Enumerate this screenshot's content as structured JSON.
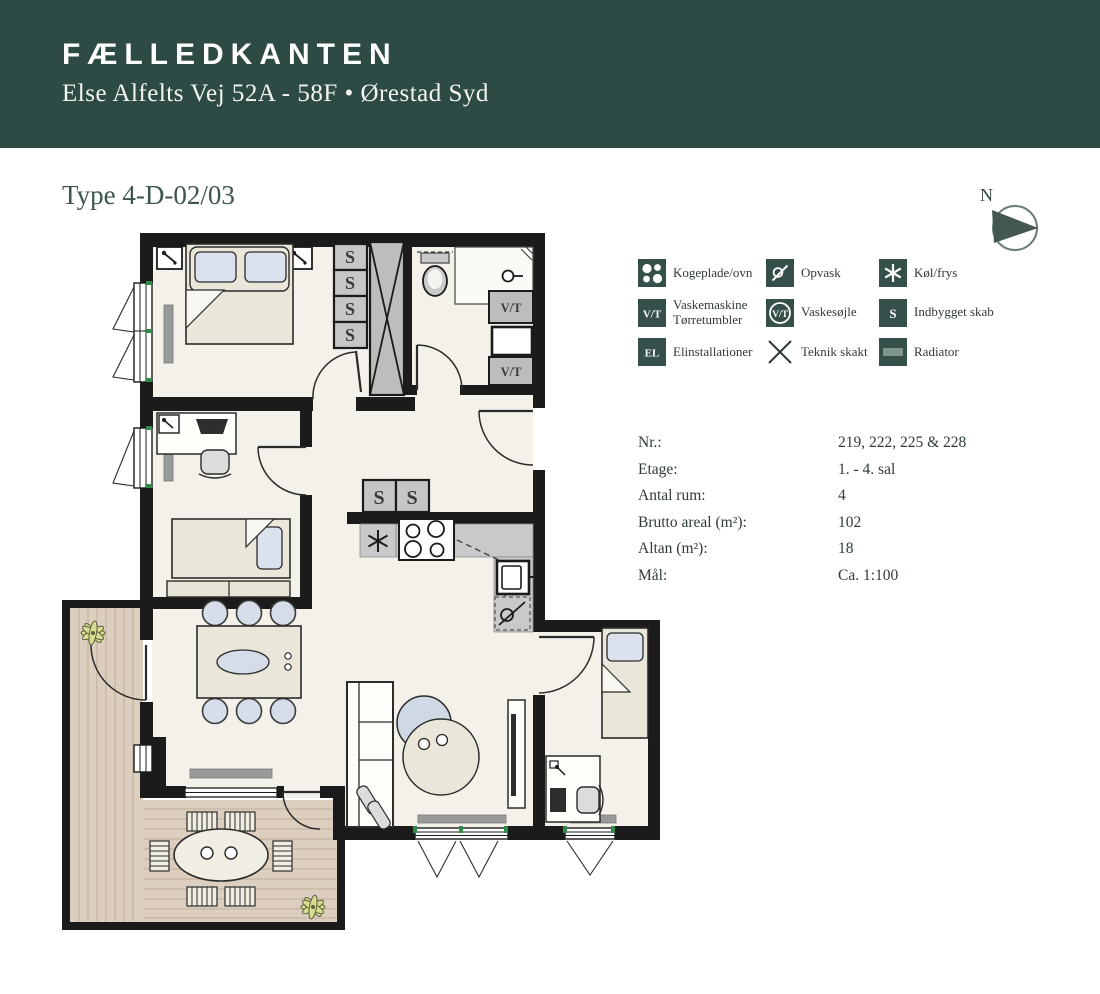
{
  "header": {
    "title": "FÆLLEDKANTEN",
    "address": "Else Alfelts Vej 52A - 58F • Ørestad Syd"
  },
  "plan": {
    "type_label": "Type 4-D-02/03"
  },
  "compass": {
    "label": "N"
  },
  "legend": {
    "items": [
      {
        "id": "hob",
        "label": "Kogeplade/ovn"
      },
      {
        "id": "dishwasher",
        "label": "Opvask"
      },
      {
        "id": "fridge-freezer",
        "label": "Køl/frys"
      },
      {
        "id": "washer-dryer",
        "label": "Vaskemaskine",
        "label2": "Tørretumbler"
      },
      {
        "id": "wash-column",
        "label": "Vaskesøjle"
      },
      {
        "id": "built-in-closet",
        "label": "Indbygget skab"
      },
      {
        "id": "electrical",
        "label": "Elinstallationer"
      },
      {
        "id": "tech-shaft",
        "label": "Teknik skakt"
      },
      {
        "id": "radiator",
        "label": "Radiator"
      }
    ],
    "icon_letters": {
      "vt": "V/T",
      "s": "S",
      "el": "EL"
    }
  },
  "details": {
    "rows": [
      {
        "label": "Nr.:",
        "value": "219, 222, 225 & 228"
      },
      {
        "label": "Etage:",
        "value": "1. - 4. sal"
      },
      {
        "label": "Antal rum:",
        "value": "4"
      },
      {
        "label": "Brutto areal (m²):",
        "value": "102"
      },
      {
        "label": "Altan (m²):",
        "value": "18"
      },
      {
        "label": "Mål:",
        "value": "Ca. 1:100"
      }
    ]
  },
  "floorplan": {
    "s": "S",
    "vt": "V/T"
  },
  "colors": {
    "banner_green": "#2d4a44",
    "icon_green": "#35504a",
    "wall_black": "#1b1b1b",
    "floor": "#f3f1ea",
    "deck": "#dccfc0",
    "gray_box": "#c6c6c6",
    "beige_furniture": "#eae6d9",
    "blue_textile": "#d6dde9",
    "radiator_gray": "#9a9a9a",
    "window_tick_green": "#2e8b49"
  }
}
